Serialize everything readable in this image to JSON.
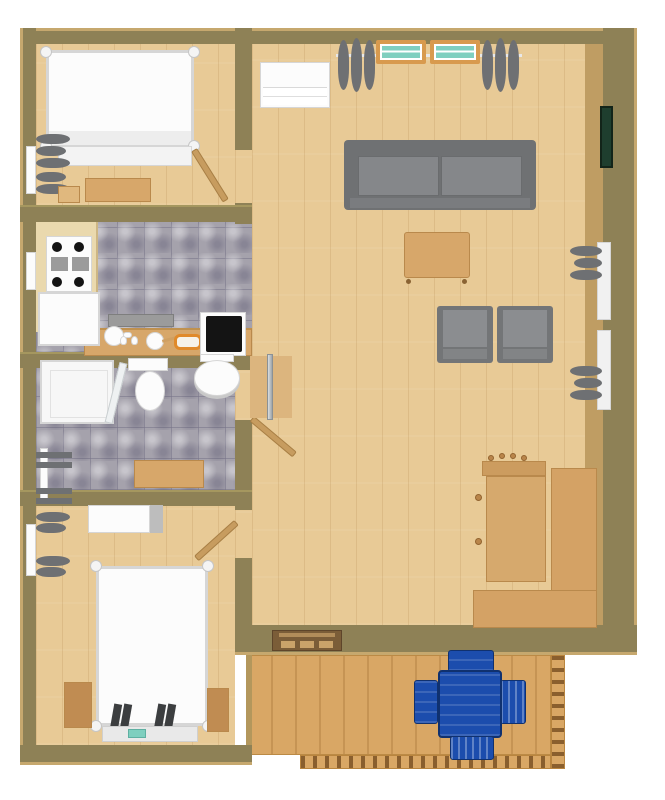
{
  "palette": {
    "background": "#ffffff",
    "wall": "#8e8156",
    "wall_edge": "#c6a86e",
    "wall_inner_face": "#bf9d63",
    "wood_floor": "#e8ca96",
    "tile_base": "#a5a2ac",
    "deck_floor": "#d9a765",
    "deck_rail_dark": "#8a5f2e",
    "gray_upholstery": "#7d7f82",
    "gray_curtain": "#6e7073",
    "white_furniture": "#fcfcfc",
    "white_furniture_edge": "#d6d6d6",
    "wood_furniture": "#d7a76a",
    "wood_furniture_dark": "#b9894c",
    "wood_door": "#c79c5f",
    "blue_furniture": "#1c4dad",
    "blue_furniture_dark": "#10316f",
    "window_glass": "#7fcfbf",
    "window_sill": "#d89a4e",
    "picture_green": "#1e3e2e",
    "appliance_black": "#141414",
    "counter_beige": "#ead9ae",
    "steel_gray": "#9b9b9b",
    "mat_brown": "#7b5d38",
    "mat_light": "#caa36a"
  },
  "labels": {
    "building": "house floor plan",
    "bedroom1": "bedroom (top left)",
    "kitchen": "kitchen",
    "bathroom": "bathroom",
    "bedroom2": "bedroom (bottom left)",
    "living_room": "living room",
    "deck": "deck with railing",
    "bed": "double bed with posts",
    "sofa": "gray sofa",
    "armchair": "gray armchair",
    "coffee_table": "coffee table",
    "desk": "L-shaped desk",
    "desk_chair": "wooden desk chair",
    "stove": "cooktop stove",
    "fridge": "refrigerator",
    "island": "kitchen counter island",
    "counter": "kitchen counter",
    "sink_unit": "kitchen sink",
    "shower": "shower stall",
    "toilet": "toilet",
    "sink": "pedestal sink",
    "towel_rack": "towel rack",
    "bench": "wooden bench",
    "dresser": "dresser",
    "nightstand": "nightstand",
    "window": "window with curtains",
    "door": "interior door",
    "doormat": "doormat",
    "picture": "wall picture",
    "coat_rack": "wall coat rack",
    "deck_table": "blue patio table",
    "deck_chair": "blue patio chair",
    "cabinet": "white cabinet",
    "chest": "storage chest",
    "foot_bench": "bedroom bench",
    "kettle": "kettle",
    "plate": "plate",
    "tray": "bread tray",
    "appliance": "black cooktop unit",
    "slippers": "slippers"
  }
}
